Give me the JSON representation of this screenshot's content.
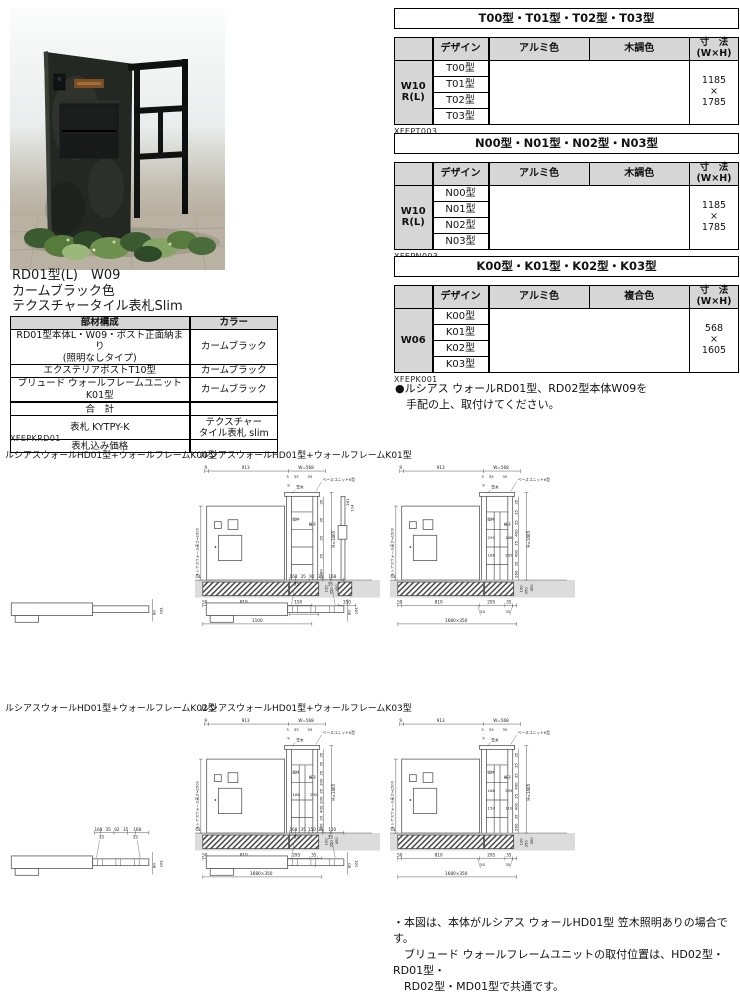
{
  "photo": {
    "caption_lines": [
      "RD01型(L)　W09",
      "カームブラック色",
      "テクスチャータイル表札Slim"
    ]
  },
  "left_table": {
    "headers": [
      "部材構成",
      "カラー"
    ],
    "rows": [
      {
        "part": "RD01型本体L・W09・ポスト正面納まり\n(照明なしタイプ)",
        "color": "カームブラック"
      },
      {
        "part": "エクステリアポストT10型",
        "color": "カームブラック"
      },
      {
        "part": "ブリュード ウォールフレームユニットK01型",
        "color": "カームブラック"
      },
      {
        "part": "合　計",
        "color": ""
      },
      {
        "part": "表札 KYTPY-K",
        "color": "テクスチャー\nタイル表札 slim"
      },
      {
        "part": "表札込み価格",
        "color": ""
      }
    ],
    "code": "XFEPKRD01"
  },
  "right_tables": [
    {
      "title": "T00型・T01型・T02型・T03型",
      "design_header": "デザイン",
      "col1": "アルミ色",
      "col2": "木調色",
      "size_header": "寸　法\n(W×H)",
      "row_header": "W10\nR(L)",
      "designs": [
        "T00型",
        "T01型",
        "T02型",
        "T03型"
      ],
      "size": "1185\n×\n1785",
      "code": "XFEPT003"
    },
    {
      "title": "N00型・N01型・N02型・N03型",
      "design_header": "デザイン",
      "col1": "アルミ色",
      "col2": "木調色",
      "size_header": "寸　法\n(W×H)",
      "row_header": "W10\nR(L)",
      "designs": [
        "N00型",
        "N01型",
        "N02型",
        "N03型"
      ],
      "size": "1185\n×\n1785",
      "code": "XFEPN003"
    },
    {
      "title": "K00型・K01型・K02型・K03型",
      "design_header": "デザイン",
      "col1": "アルミ色",
      "col2": "複合色",
      "size_header": "寸　法\n(W×H)",
      "row_header": "W06",
      "designs": [
        "K00型",
        "K01型",
        "K02型",
        "K03型"
      ],
      "size": "568\n×\n1605",
      "code": "XFEPK001"
    }
  ],
  "bullet_note": "●ルシアス ウォールRD01型、RD02型本体W09を\n　手配の上、取付けてください。",
  "bottom_note": "・本図は、本体がルシアス ウォールHD01型 笠木照明ありの場合です。\n　ブリュード ウォールフレームユニットの取付位置は、HD02型・RD01型・\n　RD02型・MD01型で共通です。",
  "diagram_common": {
    "part_labels": [
      "ベースユニットK型",
      "笠木",
      "縦枠",
      "格子"
    ],
    "left_label": "ルシアスウォール高さ≒1500",
    "gl": "GL"
  },
  "diagrams": [
    {
      "label": "ルシアスウォールHD01型+ウォールフレームK00型",
      "variant": "A",
      "plan": {
        "row1": [],
        "row2": [],
        "side": [
          "80",
          "161"
        ]
      },
      "top_dims": [
        "9",
        "913",
        "W=568"
      ],
      "sub_dims": [
        "3",
        "35",
        "35",
        "9"
      ],
      "right_dims": [
        "35",
        "35",
        "35",
        "35",
        "1060"
      ],
      "h_total": "H=1465",
      "inner_dims": [],
      "ground_dims": [
        "100",
        "350",
        "450"
      ],
      "bottom_dims": [
        "50",
        "810",
        "150"
      ],
      "bottom_extra": [
        "250",
        "350"
      ],
      "bottom_total": "1100",
      "post_dims": [
        "161",
        "114"
      ],
      "post_bottom": "350"
    },
    {
      "label": "ルシアスウォールHD01型+ウォールフレームK01型",
      "variant": "B",
      "plan": {
        "row1": [
          "168",
          "35",
          "92",
          "35",
          "168"
        ],
        "row2": [
          "35",
          "35"
        ],
        "side": [
          "80",
          "161"
        ]
      },
      "top_dims": [
        "9",
        "913",
        "W=568"
      ],
      "sub_dims": [
        "3",
        "35",
        "35",
        "9"
      ],
      "right_dims": [
        "35",
        "35",
        "35",
        "400",
        "35",
        "400",
        "35",
        "260"
      ],
      "h_total": "H=1465",
      "inner_dims": [
        "295",
        "168",
        "168",
        "295"
      ],
      "ground_dims": [
        "100",
        "350",
        "450"
      ],
      "bottom_dims": [
        "50",
        "810",
        "295",
        "35"
      ],
      "bottom_sub": [
        "50",
        "35"
      ],
      "bottom_total": "1680×350"
    },
    {
      "label": "ルシアスウォールHD01型+ウォールフレームK02型",
      "variant": "B",
      "plan": {
        "row1": [
          "168",
          "35",
          "92",
          "35",
          "168"
        ],
        "row2": [
          "35",
          "35"
        ],
        "side": [
          "80",
          "161"
        ]
      },
      "top_dims": [
        "9",
        "913",
        "W=568"
      ],
      "sub_dims": [
        "3",
        "35",
        "35",
        "9"
      ],
      "right_dims": [
        "35",
        "35",
        "35",
        "200",
        "35",
        "200",
        "400",
        "35",
        "260"
      ],
      "h_total": "H=1465",
      "inner_dims": [
        "168",
        "295"
      ],
      "ground_dims": [
        "100",
        "350",
        "450"
      ],
      "bottom_dims": [
        "50",
        "810",
        "295",
        "35"
      ],
      "bottom_sub": [
        "50",
        "35"
      ],
      "bottom_total": "1680×350"
    },
    {
      "label": "ルシアスウォールHD01型+ウォールフレームK03型",
      "variant": "B",
      "plan": {
        "row1": [
          "168",
          "35",
          "150",
          "35",
          "110"
        ],
        "row2": [
          "35",
          "35"
        ],
        "side": [
          "80",
          "161"
        ]
      },
      "top_dims": [
        "9",
        "913",
        "W=568"
      ],
      "sub_dims": [
        "3",
        "35",
        "35",
        "9"
      ],
      "right_dims": [
        "35",
        "35",
        "35",
        "400",
        "35",
        "400",
        "35",
        "260"
      ],
      "h_total": "H=1465",
      "inner_dims": [
        "168",
        "295",
        "150",
        "110"
      ],
      "ground_dims": [
        "100",
        "350",
        "450"
      ],
      "bottom_dims": [
        "50",
        "810",
        "295",
        "35"
      ],
      "bottom_sub": [
        "50",
        "35"
      ],
      "bottom_total": "1680×350"
    }
  ]
}
